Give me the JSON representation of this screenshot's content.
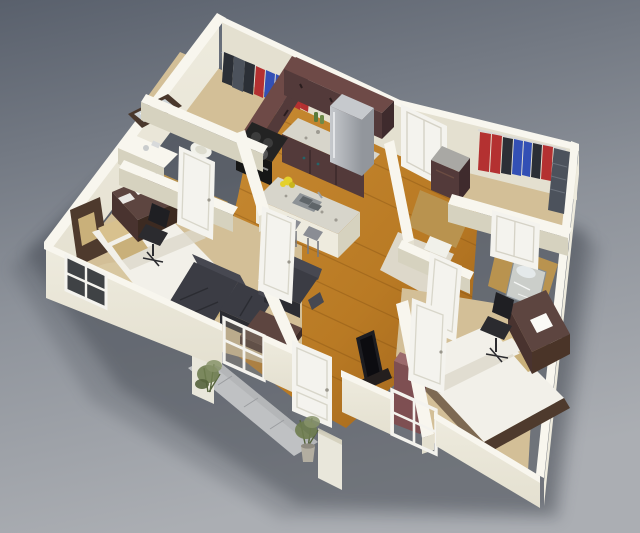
{
  "scene": {
    "type": "3d-floor-plan-render",
    "description": "Isometric 3D render of a two-bedroom, two-bathroom apartment floor plan on a gray studio background",
    "rooms": [
      {
        "name": "walk-in-closet-left",
        "floor": "carpet",
        "contents": [
          "clothes-rail",
          "hanging-clothes"
        ]
      },
      {
        "name": "kitchen",
        "floor": "wood",
        "contents": [
          "upper-cabinets",
          "counter",
          "stove",
          "refrigerator",
          "island-with-sink",
          "bar-stools",
          "flowers"
        ]
      },
      {
        "name": "bathroom-left",
        "floor": "wood",
        "contents": [
          "mirror",
          "vanity-sink",
          "toilet"
        ]
      },
      {
        "name": "bedroom-left",
        "floor": "carpet",
        "contents": [
          "double-bed",
          "desk",
          "office-chair",
          "window"
        ]
      },
      {
        "name": "living-room",
        "floor": "wood",
        "contents": [
          "sectional-sofa",
          "armchair",
          "coffee-table",
          "tv",
          "window"
        ]
      },
      {
        "name": "laundry-closet",
        "floor": "wood",
        "contents": [
          "washer-dryer"
        ]
      },
      {
        "name": "bathroom-right",
        "floor": "tile",
        "contents": [
          "toilet",
          "glass-sink"
        ]
      },
      {
        "name": "walk-in-closet-right",
        "floor": "carpet",
        "contents": [
          "clothes-rail",
          "hanging-clothes",
          "garment-bag"
        ]
      },
      {
        "name": "bedroom-right",
        "floor": "carpet",
        "contents": [
          "double-bed",
          "desk",
          "office-chair",
          "dresser",
          "window"
        ]
      },
      {
        "name": "entry",
        "contents": [
          "walkway-slab",
          "planter-walls",
          "potted-plant-left",
          "potted-plant-right",
          "entry-door"
        ]
      }
    ],
    "doors": [
      "entry-door-open",
      "bathroom-left-door",
      "bedroom-left-door",
      "bedroom-right-door",
      "bathroom-right-door",
      "closet-right-door-closed",
      "hall-door-closed"
    ],
    "windows": [
      "bedroom-left-window",
      "living-room-window",
      "bedroom-right-window"
    ]
  },
  "palette": {
    "bgTop": "#59606c",
    "bgMid": "#8d929a",
    "bgBottom": "#abaeb3",
    "shadow": "#3a4049",
    "wallTop": "#f8f6ee",
    "wallLight": "#eeebde",
    "wallMid": "#e4e0d0",
    "wallShade": "#d6d2bf",
    "wallDark": "#c4bfa9",
    "wood": "#b97a24",
    "woodLight": "#c88b33",
    "woodDark": "#9c611a",
    "plank": "#7e4d12",
    "carpet": "#d3bf97",
    "carpetDark": "#c3ae83",
    "bathWood": "#b9934f",
    "tile": "#ddd8ca",
    "cabinet": "#6e4a47",
    "cabinetDark": "#533a3a",
    "cabinetDeep": "#3f2b2d",
    "counter": "#d7d5cb",
    "speckle": "#9e9b92",
    "steel": "#c6c9cd",
    "steelDark": "#92969c",
    "black": "#1d1d21",
    "sofa": "#3b3c44",
    "sofaDark": "#2b2c32",
    "sofaLight": "#474851",
    "tableWood": "#5d4540",
    "tableDark": "#49332f",
    "duvet": "#f2f0e9",
    "duvetShade": "#dcd8cb",
    "pillowTan": "#d8c18e",
    "pillowDark": "#c9b07a",
    "headboard": "#4e3a2d",
    "clothesRed": "#b43131",
    "clothesBlue": "#3350b5",
    "clothesGray": "#4c525c",
    "clothesDark": "#2b2f36",
    "doorWhite": "#f4f3ee",
    "doorShade": "#dcdad0",
    "glass": "#ccd2d5",
    "path": "#bfc1c3",
    "pathDark": "#a9abad",
    "planter": "#e9e7db",
    "plant": "#6f7d50",
    "plantDark": "#55633c",
    "pot": "#b3aea1",
    "flower": "#e4d02c",
    "toilet": "#f1f1ea",
    "mirrorFrame": "#4a382c",
    "mirrorGlass": "#ccd3d6",
    "paper": "#fafaf6"
  }
}
